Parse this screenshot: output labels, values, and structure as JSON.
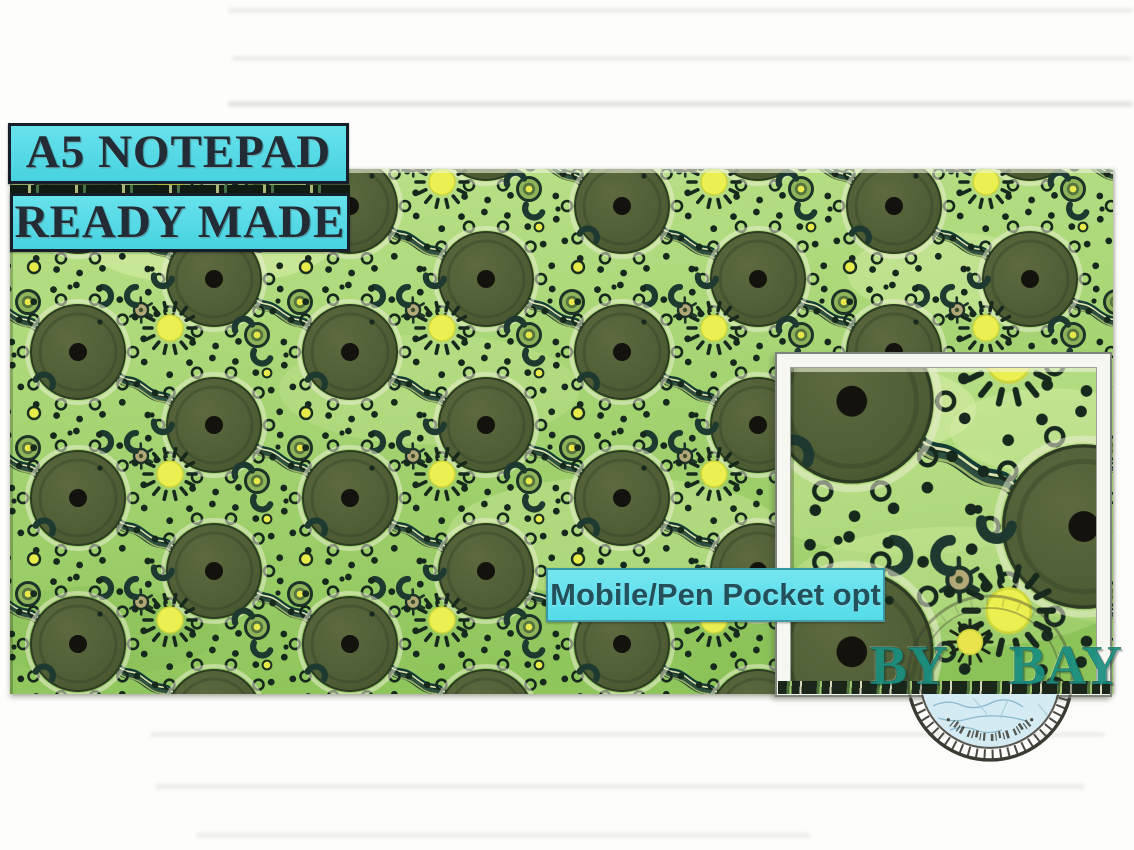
{
  "badges": {
    "a5": "A5 NOTEPAD",
    "ready": "READY MADE",
    "pocket": "Mobile/Pen Pocket opt"
  },
  "brand": {
    "left": "BY",
    "right": "BAY"
  },
  "colors": {
    "badge_bg": "#52d8e5",
    "badge_border": "#161f29",
    "badge_text": "#232c35",
    "pocket_text": "#23505a",
    "fabric_green_light": "#bce28a",
    "fabric_green_deep": "#8fc65c",
    "motif_ink": "#17291d",
    "circle_olive": "#4d5c33",
    "accent_yellow": "#e9ee4d",
    "brand_teal": "#1a8f80",
    "stamp_ink": "#3b3a33",
    "stamp_water": "#d5ebf4"
  },
  "motifs": [
    "concentric-ring-circle",
    "sun-dot",
    "journey-river",
    "u-symbol",
    "turtle-dot",
    "target-dot"
  ]
}
